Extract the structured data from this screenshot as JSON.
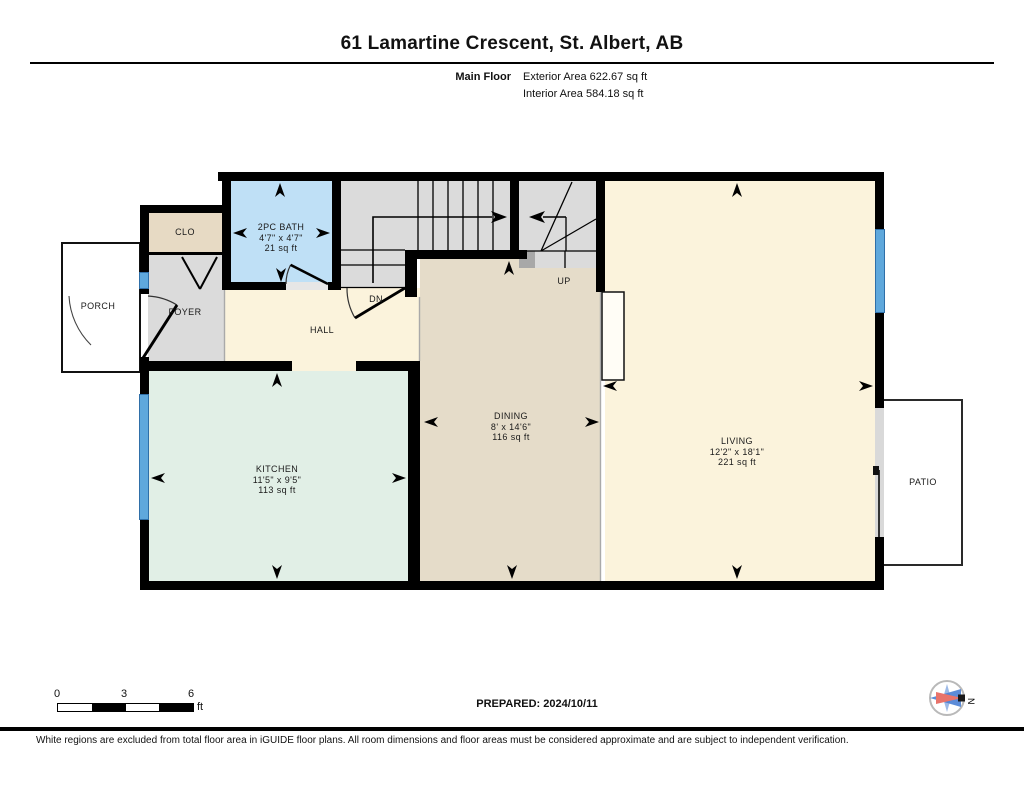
{
  "header": {
    "title": "61 Lamartine Crescent, St. Albert, AB",
    "floor_label": "Main Floor",
    "exterior_area": "Exterior Area 622.67 sq ft",
    "interior_area": "Interior Area 584.18 sq ft"
  },
  "rooms": [
    {
      "id": "bath",
      "name": "2PC BATH",
      "dims": "4'7\" x 4'7\"",
      "area": "21 sq ft"
    },
    {
      "id": "kitchen",
      "name": "KITCHEN",
      "dims": "11'5\" x 9'5\"",
      "area": "113 sq ft"
    },
    {
      "id": "dining",
      "name": "DINING",
      "dims": "8' x 14'6\"",
      "area": "116 sq ft"
    },
    {
      "id": "living",
      "name": "LIVING",
      "dims": "12'2\" x 18'1\"",
      "area": "221 sq ft"
    }
  ],
  "labels": {
    "clo": "CLO",
    "foyer": "FOYER",
    "hall": "HALL",
    "dn": "DN",
    "up": "UP",
    "porch": "PORCH",
    "patio": "PATIO"
  },
  "scale_bar": {
    "ticks": [
      "0",
      "3",
      "6"
    ],
    "unit": "ft"
  },
  "prepared": "PREPARED: 2024/10/11",
  "compass": {
    "north_label": "N"
  },
  "footer": "White regions are excluded from total floor area in iGUIDE floor plans. All room dimensions and floor areas must be considered approximate and are subject to independent verification.",
  "colors": {
    "c-bath": "#bfe0f6",
    "c-kitchen": "#e1efe6",
    "c-dining": "#e5dcc9",
    "c-cream": "#fbf3dc",
    "c-gray": "#dbdbdb",
    "c-clo": "#e7dac4",
    "c-window": "#5fa8dc",
    "c-compass-blue": "#4a7fd4",
    "c-compass-red": "#e8736b"
  }
}
